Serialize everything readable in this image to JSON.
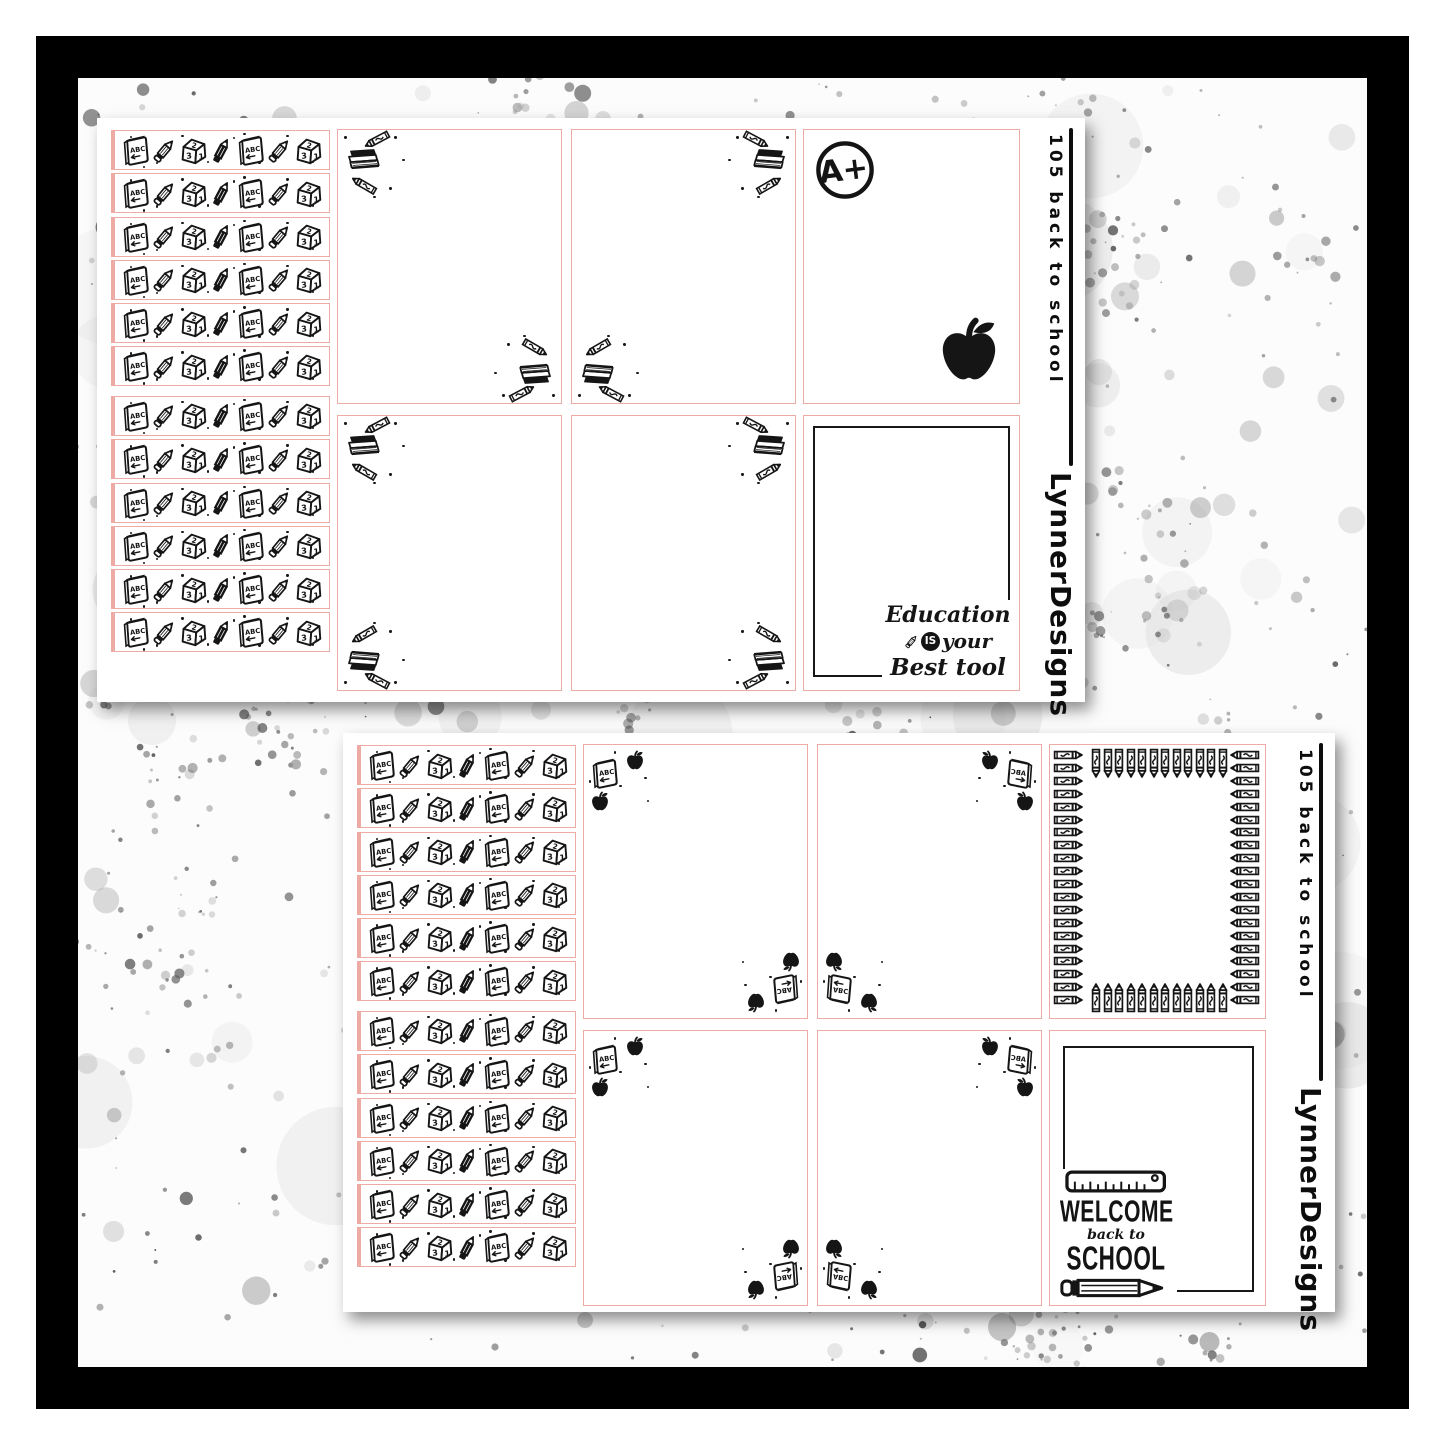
{
  "product": {
    "kit_code": "105 back to school",
    "brand": "LynnerDesigns"
  },
  "sheets": [
    {
      "name": "top-sheet",
      "code": "105 back to school",
      "brand": "LynnerDesigns",
      "grade_label": "A+",
      "quote": {
        "line1": "Education",
        "is": "IS",
        "line2": "your",
        "line3": "Best tool"
      },
      "corner_theme": "books-and-crayons"
    },
    {
      "name": "bottom-sheet",
      "code": "105 back to school",
      "brand": "LynnerDesigns",
      "welcome": {
        "line1": "WELCOME",
        "line2": "back to",
        "line3": "SCHOOL"
      },
      "corner_theme": "books-and-apples"
    }
  ],
  "washi": {
    "strip_count": 12,
    "icons": [
      "abc-book",
      "pencil",
      "number-cube",
      "pen",
      "abc-book",
      "pencil",
      "number-cube"
    ],
    "book_label": "ABC",
    "cube_digits": [
      "3",
      "2",
      "1"
    ]
  },
  "decor": {
    "crayon_frame": {
      "top": 12,
      "bottom": 12,
      "left": 20,
      "right": 20
    },
    "icon_names": [
      "abc-book-icon",
      "pencil-icon",
      "number-cube-icon",
      "pen-icon",
      "books-stack-icon",
      "crayon-icon",
      "apple-icon",
      "ruler-icon",
      "a-plus-icon"
    ]
  },
  "colors": {
    "sticker_border": "#eeaaa5",
    "ink": "#151515",
    "frame": "#000000",
    "splatter_grays": [
      "#8f8f8f",
      "#b5b5b5",
      "#d6d6d6"
    ]
  }
}
